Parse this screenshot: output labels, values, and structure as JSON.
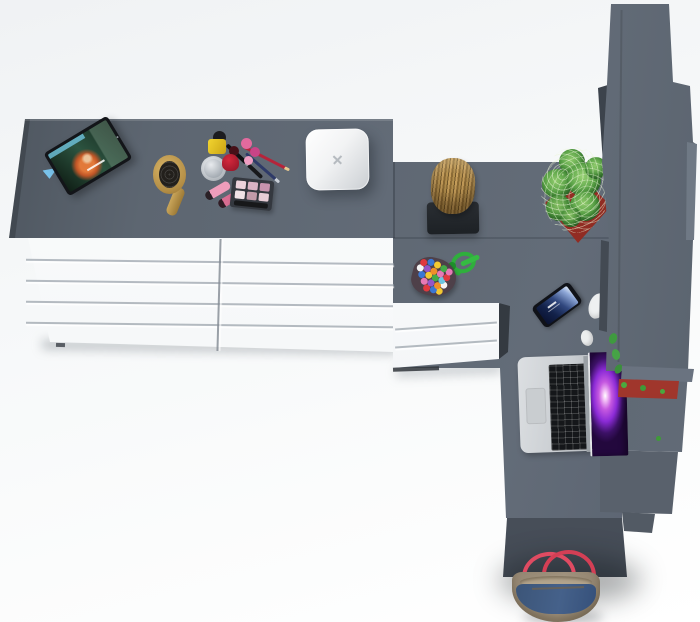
{
  "meta": {
    "description": "Isometric top-down 3D product render of an L-shaped bedroom furniture set on a white studio floor, styled with lifestyle props",
    "view": "top-down product render, no visible text"
  },
  "palette": {
    "background": "#f4f6f7",
    "furniture_top": "#5d6671",
    "desk_surface": "#5d6671",
    "wardrobe_gray": "#59616c",
    "wardrobe_dark_edge": "#3c434c",
    "drawer_front_white": "#fbfcfd",
    "drawer_line": "#97a0a8",
    "lower_cabinet": "#4e5560",
    "planter_red": "#a93a30",
    "cactus_green": "#4e9a3f",
    "log_wood": "#a98648",
    "brush_wood": "#c3a054",
    "candy_cord_green": "#2faf3c",
    "bag_denim": "#45618a",
    "bag_trim": "#a1937e",
    "bag_handle_red": "#e04b62",
    "laptop_silver": "#c9cdd1",
    "laptop_screen_purple": "#8b2bd6",
    "tablet_black": "#131519",
    "white_box": "#f2f3f4"
  },
  "scene": {
    "furniture": [
      {
        "id": "dresser",
        "label": "Long double dresser: gray top, white drawer fronts (two banks of five drawers)"
      },
      {
        "id": "dressing-desk",
        "label": "Gray L-shaped dressing desk return joining dresser to wardrobe"
      },
      {
        "id": "nightstand",
        "label": "Small white 3-drawer chest under the desk corner"
      },
      {
        "id": "wardrobe",
        "label": "Tall dark-gray wardrobe / shelf column along right edge"
      },
      {
        "id": "lower-cabinet",
        "label": "Dark under-desk cabinet at bottom with floor shadow"
      }
    ],
    "objects": [
      {
        "id": "tablet",
        "label": "Tablet propped on dresser playing an animated movie with a red-haired character"
      },
      {
        "id": "hairbrush",
        "label": "Wooden paddle hairbrush with dark bristles"
      },
      {
        "id": "cosmetics",
        "label": "Makeup set: yellow and red nail polish, silver cream jar, pink mini bottles, two pink lipsticks, three makeup pencils, eyeshadow palette"
      },
      {
        "id": "white-box",
        "label": "White rounded square box / speaker with small x mark"
      },
      {
        "id": "log-stool",
        "label": "Natural wood log stool on a dark mat"
      },
      {
        "id": "candy-pouch",
        "label": "Pouch of multicolored beads tied with a green cord"
      },
      {
        "id": "smartphone",
        "label": "Smartphone with glowing blue lock screen"
      },
      {
        "id": "earbuds",
        "label": "White earphones partly hidden behind the wardrobe edge"
      },
      {
        "id": "laptop",
        "label": "Open silver laptop, black keys, purple nebula wallpaper"
      },
      {
        "id": "cactus",
        "label": "Spiky green cactus in a red square planter beside the wardrobe"
      },
      {
        "id": "red-planter",
        "label": "Red window-box planter with small green succulents on wardrobe shelf"
      },
      {
        "id": "handbag",
        "label": "Denim-and-tan tote bag with red handles on the floor below the cabinet"
      }
    ]
  }
}
